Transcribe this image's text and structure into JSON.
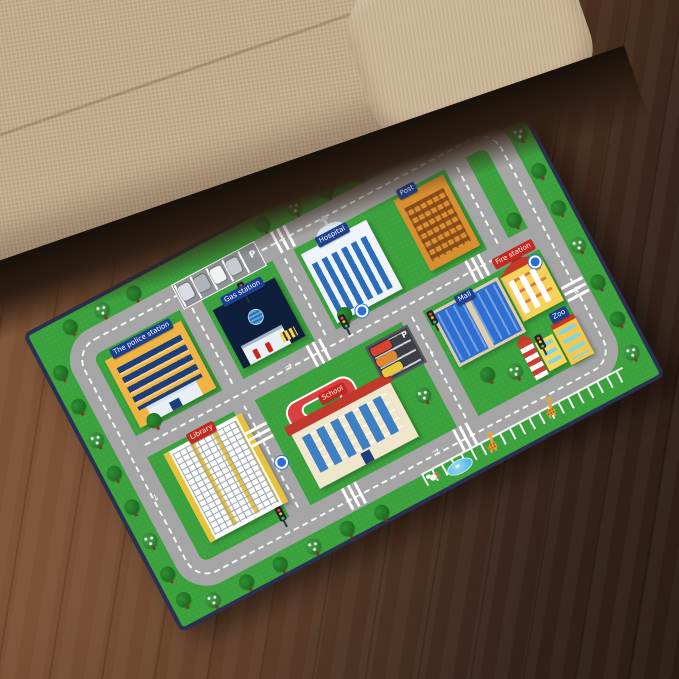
{
  "scene": {
    "subject": "Kids city traffic road play mat rug lying on a wooden floor next to a beige fabric sofa"
  },
  "colors": {
    "mat_green": "#3aa13c",
    "road_gray": "#a5a5a5",
    "mat_border_navy": "#2b3050",
    "sign_blue": "#1d3f8f",
    "sign_red": "#c5271d",
    "couch_beige": "#c6ae90",
    "floor_brown_light": "#7c5133",
    "floor_brown_dark": "#2a1b11"
  },
  "mat": {
    "labels": {
      "police_station": "The police station",
      "gas_station": "Gas station",
      "hospital": "Hospital",
      "post_office": "Post",
      "fire_station": "Fire station",
      "mall": "Mall",
      "school": "School",
      "library": "Library",
      "zoo": "Zoo",
      "parking_letter": "P"
    }
  }
}
